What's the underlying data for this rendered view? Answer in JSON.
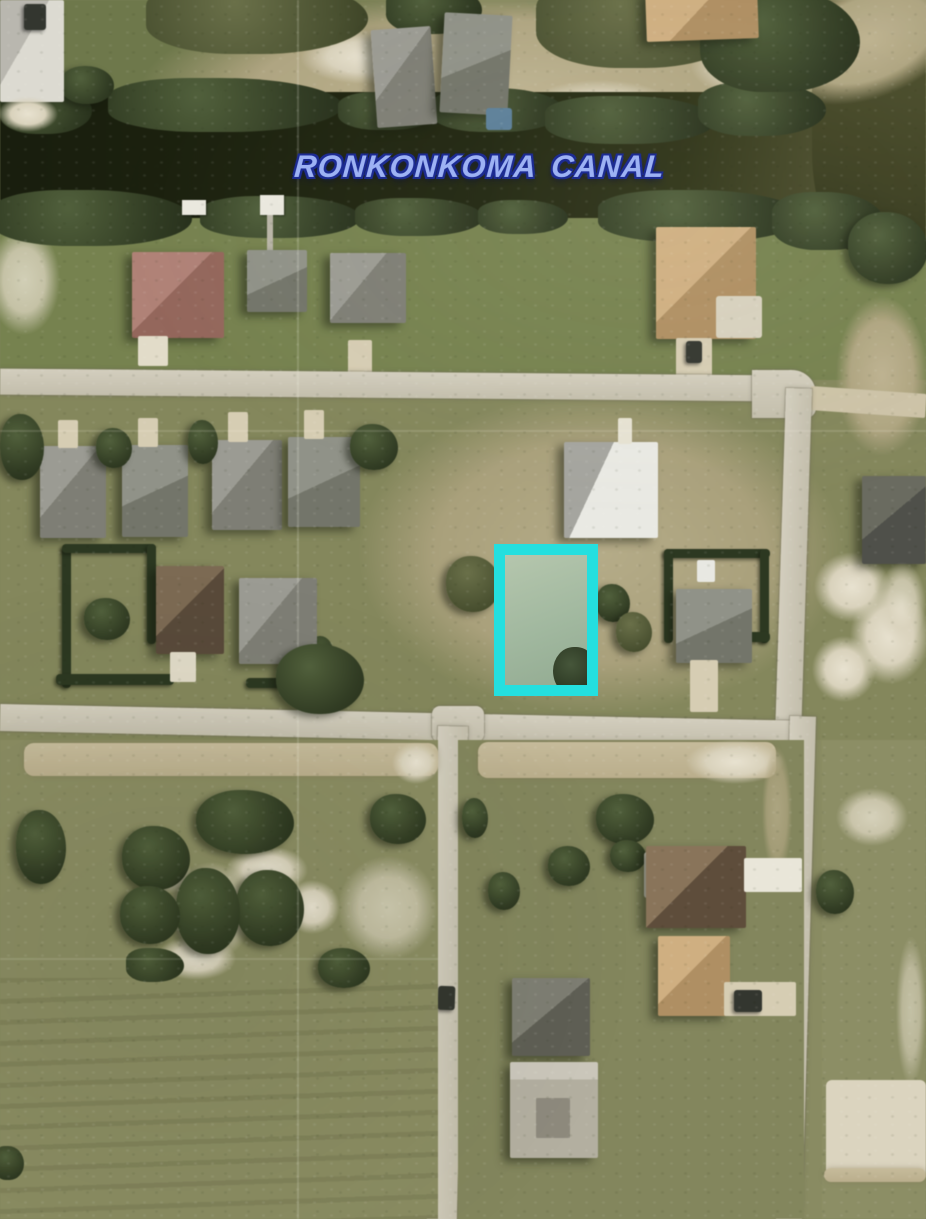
{
  "annotation": {
    "canal_label": "RONKONKOMA CANAL",
    "canal_label_fill_color": "#9DB2F4",
    "canal_label_outline_color": "#1C2B92",
    "highlighted_lot": {
      "border_color": "#24DFDF",
      "border_px": 11,
      "x": 494,
      "y": 544,
      "width": 104,
      "height": 152
    }
  },
  "scene": {
    "type": "aerial-photo",
    "water_color": "#20260F",
    "grass_color": "#7F855A",
    "road_color": "#CBC6B3",
    "sand_color": "#DED7C2",
    "tree_color": "#36412A",
    "roof_colors": {
      "gray": "#8B8B82",
      "dark_gray": "#5C5D52",
      "brown": "#6B5948",
      "red_brown": "#A3756A",
      "tan": "#C4A273",
      "white": "#E6E6E0"
    }
  }
}
